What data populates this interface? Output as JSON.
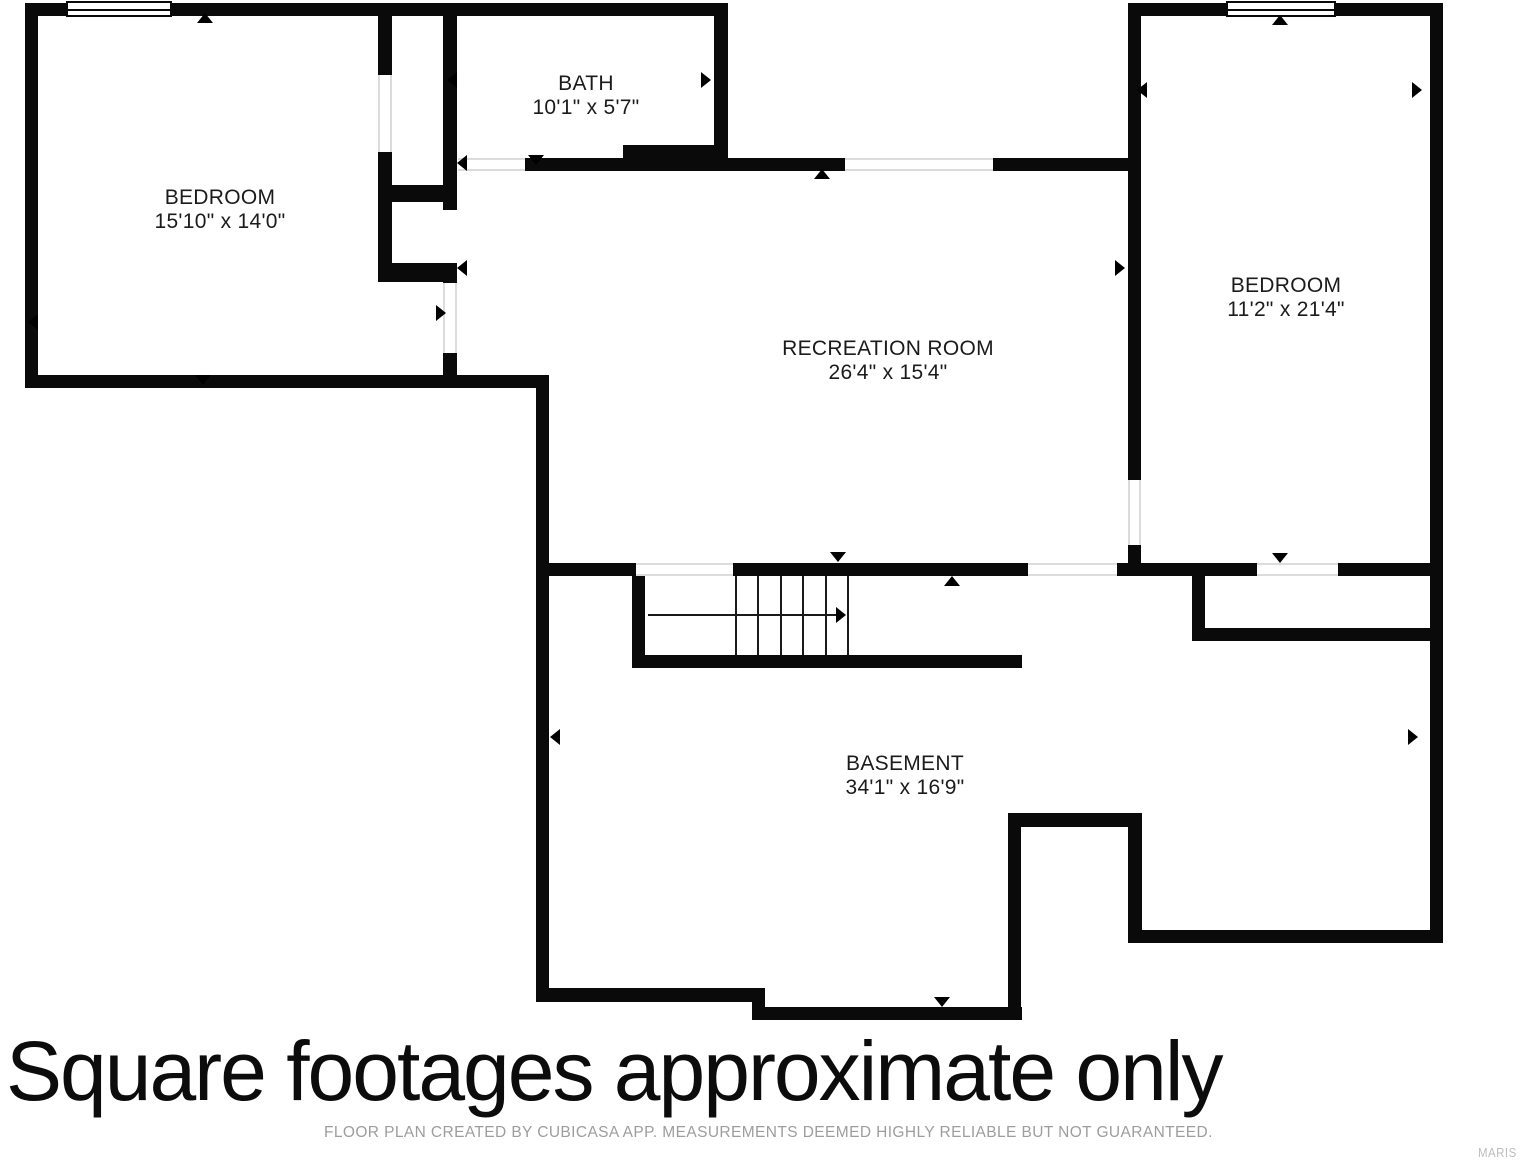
{
  "rooms": {
    "bedroom_left": {
      "name": "BEDROOM",
      "dims": "15'10\" x 14'0\""
    },
    "bath": {
      "name": "BATH",
      "dims": "10'1\" x 5'7\""
    },
    "recreation": {
      "name": "RECREATION ROOM",
      "dims": "26'4\" x 15'4\""
    },
    "bedroom_right": {
      "name": "BEDROOM",
      "dims": "11'2\" x 21'4\""
    },
    "basement": {
      "name": "BASEMENT",
      "dims": "34'1\" x 16'9\""
    }
  },
  "footer": {
    "headline": "Square footages approximate only",
    "disclaimer": "FLOOR PLAN CREATED BY CUBICASA APP. MEASUREMENTS DEEMED HIGHLY RELIABLE BUT NOT GUARANTEED.",
    "watermark": "MARIS"
  },
  "colors": {
    "wall": "#0a0a0a",
    "background": "#ffffff",
    "disclaimer_text": "#9d9d9d",
    "watermark_text": "#bdbdbd"
  }
}
